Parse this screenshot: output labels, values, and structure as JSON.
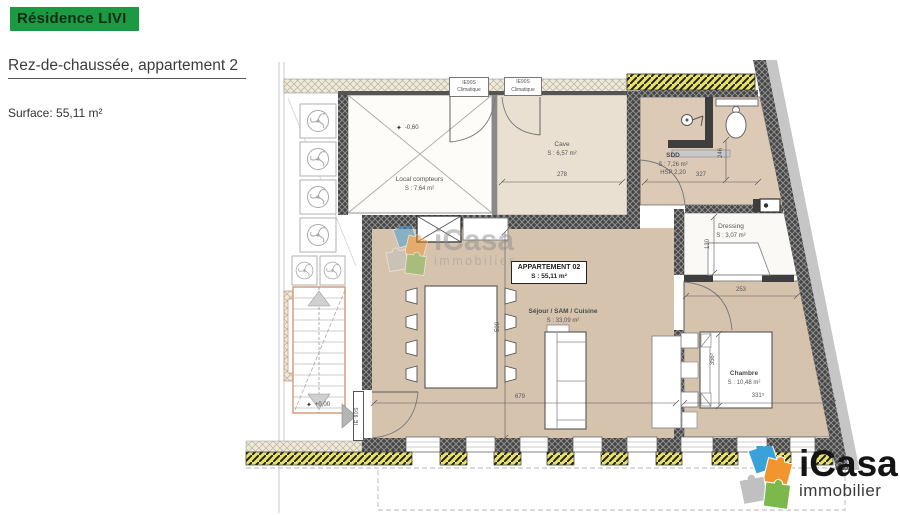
{
  "header": {
    "title": "Résidence LIVI",
    "subtitle": "Rez-de-chaussée, appartement 2",
    "surface": "Surface: 55,11 m²"
  },
  "plan": {
    "apartment_box": {
      "line1": "APPARTEMENT 02",
      "line2": "S : 55,11 m²"
    },
    "rooms": {
      "local_compteurs": {
        "name": "Local compteurs",
        "area": "S : 7,64 m²"
      },
      "cave": {
        "name": "Cave",
        "area": "S : 6,57 m²"
      },
      "sdd": {
        "name": "SDD",
        "area": "S : 7,26 m²",
        "hsp": "HSP 2,20"
      },
      "dressing": {
        "name": "Dressing",
        "area": "S : 3,07 m²"
      },
      "chambre": {
        "name": "Chambre",
        "area": "S : 10,48 m²"
      },
      "sejour": {
        "name": "Séjour / SAM / Cuisine",
        "area": "S : 33,09 m²"
      }
    },
    "doors": {
      "top_door_1": {
        "line1": "IE90S",
        "line2": "Climatique"
      },
      "top_door_2": {
        "line1": "IE90S",
        "line2": "Climatique"
      },
      "entry": "IE 90S"
    },
    "levels": {
      "local": "-0,60",
      "entrance": "+0,00"
    },
    "dims": {
      "cave_width": "278",
      "sdd_width": "327",
      "sdd_height": "246",
      "dressing_height": "130",
      "dressing_width": "253",
      "sejour_height": "500",
      "sejour_width": "679",
      "chambre_width": "331⁵",
      "chambre_height": "356⁵"
    }
  },
  "watermark": {
    "brand": "iCasa",
    "subtitle": "immobilier"
  },
  "logo": {
    "brand": "iCasa",
    "subtitle": "immobilier"
  },
  "icons": {
    "level_marker": "✦"
  },
  "colors": {
    "brand_green": "#1b9a44",
    "wall_dark": "#3e3e3e",
    "insulation_yellow": "#e8e26a",
    "room_beige": "#d6c3ae",
    "cave_beige": "#e9e0d2",
    "puzzle_blue": "#3ba1d9",
    "puzzle_orange": "#f2952f",
    "puzzle_grey": "#c0c0c0",
    "puzzle_green": "#7cb84b"
  }
}
